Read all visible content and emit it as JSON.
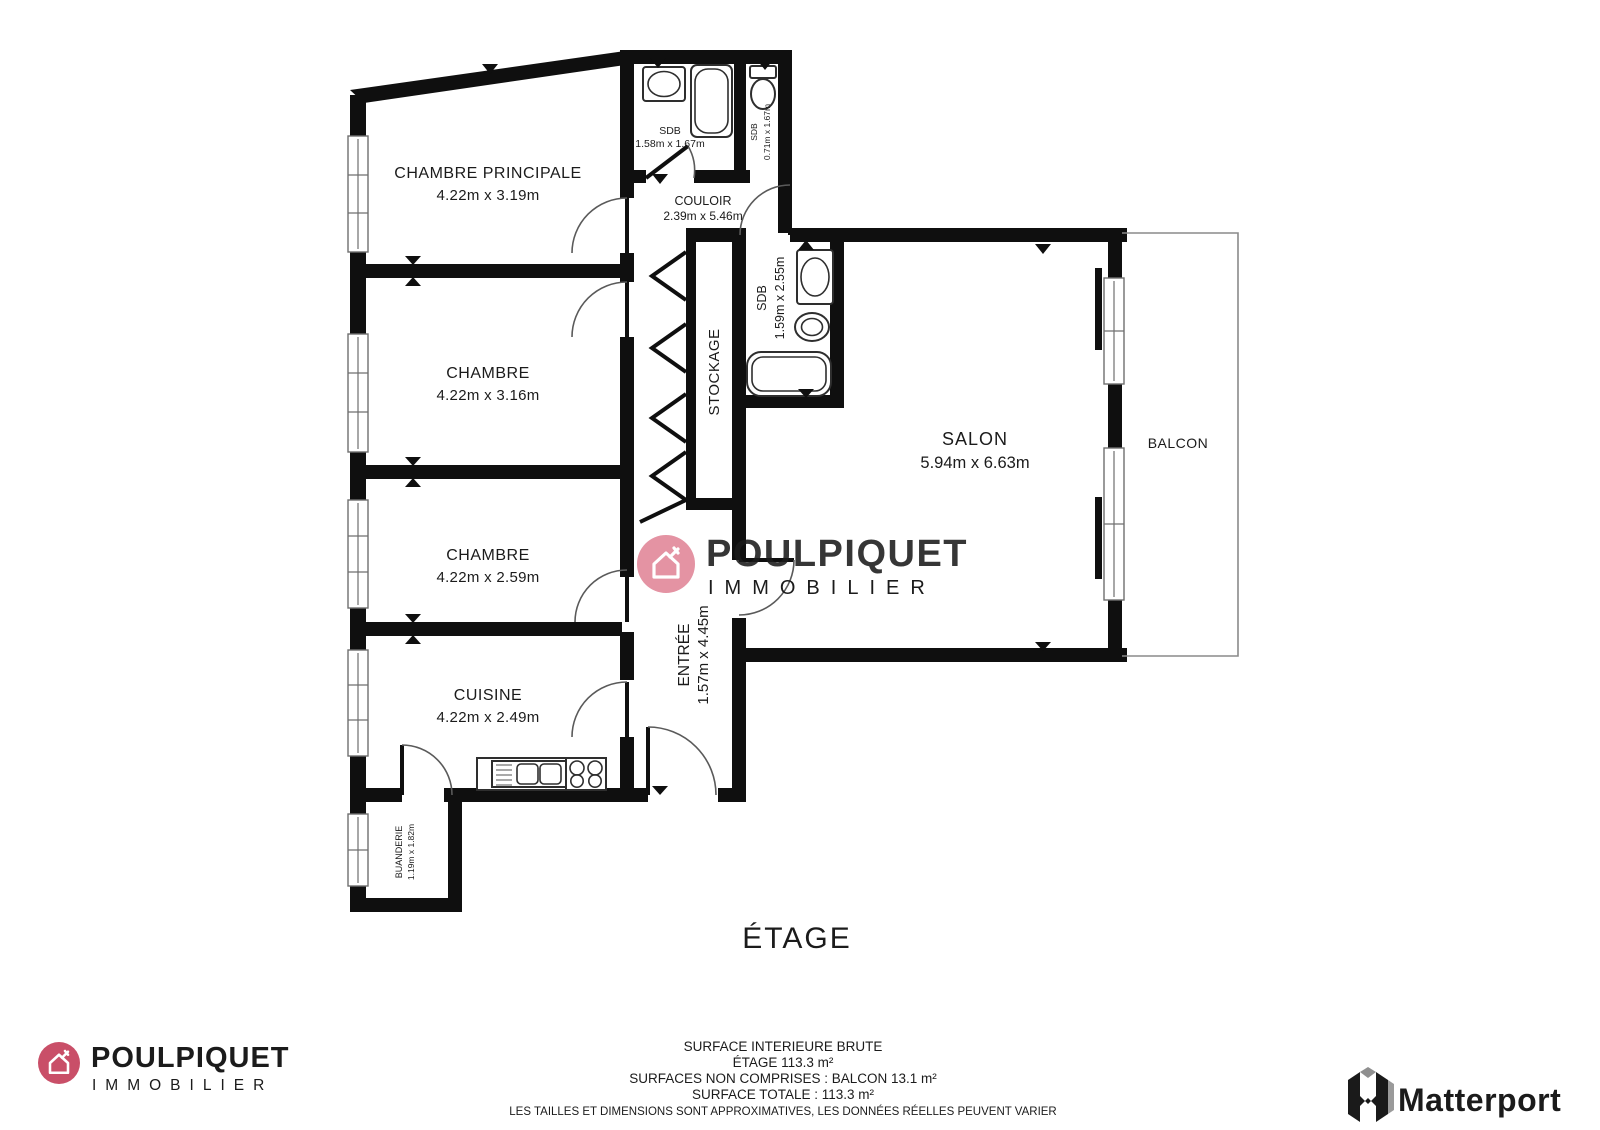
{
  "floor_label": "ÉTAGE",
  "rooms": {
    "chambre_principale": {
      "name": "CHAMBRE PRINCIPALE",
      "dims": "4.22m x 3.19m"
    },
    "chambre2": {
      "name": "CHAMBRE",
      "dims": "4.22m x 3.16m"
    },
    "chambre3": {
      "name": "CHAMBRE",
      "dims": "4.22m x 2.59m"
    },
    "cuisine": {
      "name": "CUISINE",
      "dims": "4.22m x 2.49m"
    },
    "salon": {
      "name": "SALON",
      "dims": "5.94m x 6.63m"
    },
    "balcon": {
      "name": "BALCON"
    },
    "couloir": {
      "name": "COULOIR",
      "dims": "2.39m x 5.46m"
    },
    "sdb1": {
      "name": "SDB",
      "dims": "1.58m x 1.67m"
    },
    "sdb2": {
      "name": "SDB",
      "dims": "0.71m x 1.67m"
    },
    "sdb3": {
      "name": "SDB",
      "dims": "1.59m x 2.55m"
    },
    "stockage": {
      "name": "STOCKAGE"
    },
    "entree": {
      "name": "ENTRÉE",
      "dims": "1.57m x 4.45m"
    },
    "buanderie": {
      "name": "BUANDERIE",
      "dims": "1.19m x 1.82m"
    }
  },
  "watermark": {
    "brand": "POULPIQUET",
    "sub": "IMMOBILIER"
  },
  "footer_brand": {
    "brand": "POULPIQUET",
    "sub": "IMMOBILIER"
  },
  "summary": {
    "line1": "SURFACE INTERIEURE BRUTE",
    "line2": "ÉTAGE 113.3 m²",
    "line3": "SURFACES NON COMPRISES :  BALCON 13.1 m²",
    "line4": "SURFACE TOTALE :  113.3 m²",
    "disclaimer": "LES TAILLES ET DIMENSIONS SONT APPROXIMATIVES, LES DONNÉES RÉELLES PEUVENT VARIER"
  },
  "matterport": {
    "label": "Matterport"
  },
  "colors": {
    "wall": "#0f0f0f",
    "brand_pink": "#c94f68",
    "brand_maroon": "#3a222f",
    "watermark_circle": "#e493a3",
    "watermark_text": "#6f4f5b",
    "watermark_sub": "#dd8a9b",
    "disclaimer_gray": "#8c8c8c"
  }
}
